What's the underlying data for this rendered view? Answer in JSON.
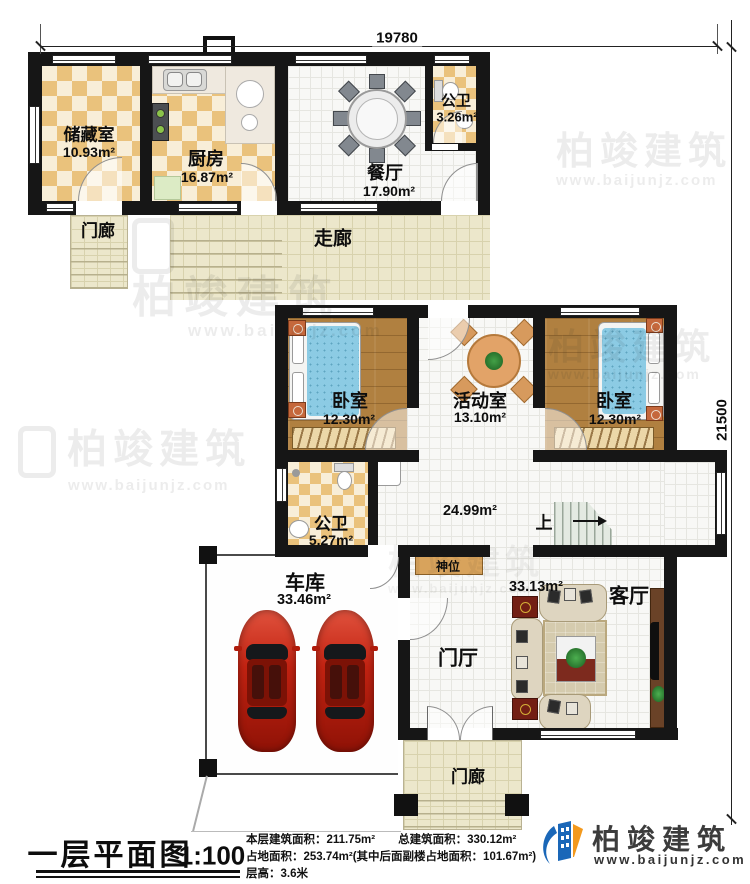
{
  "dimensions": {
    "top": "19780",
    "right": "21500"
  },
  "rooms": {
    "storage": {
      "name": "储藏室",
      "area": "10.93m²"
    },
    "kitchen": {
      "name": "厨房",
      "area": "16.87m²"
    },
    "dining": {
      "name": "餐厅",
      "area": "17.90m²"
    },
    "bath_top": {
      "name": "公卫",
      "area": "3.26m²"
    },
    "porch_top": {
      "name": "门廊"
    },
    "corridor": {
      "name": "走廊"
    },
    "bedroom_left": {
      "name": "卧室",
      "area": "12.30m²"
    },
    "activity": {
      "name": "活动室",
      "area": "13.10m²"
    },
    "bedroom_right": {
      "name": "卧室",
      "area": "12.30m²"
    },
    "bath_mid": {
      "name": "公卫",
      "area": "5.27m²"
    },
    "hall": {
      "area": "24.99m²"
    },
    "stairs": {
      "label": "上"
    },
    "shrine": {
      "name": "神位"
    },
    "garage": {
      "name": "车库",
      "area": "33.46m²"
    },
    "foyer": {
      "name": "门厅"
    },
    "living": {
      "name": "客厅",
      "area": "33.13m²"
    },
    "porch_bottom": {
      "name": "门廊"
    }
  },
  "title_block": {
    "title": "一层平面图",
    "scale": "1:100",
    "stats": [
      "本层建筑面积：211.75m²　　总建筑面积：330.12m²",
      "占地面积：253.74m²(其中后面副楼占地面积：101.67m²)",
      "层高：3.6米"
    ]
  },
  "brand": {
    "name": "柏竣建筑",
    "url": "www.baijunjz.com"
  },
  "watermark": {
    "name": "柏竣建筑",
    "url": "www.baijunjz.com"
  },
  "colors": {
    "wall": "#161616",
    "checker": "#eac27c",
    "wood": "#b08040",
    "logo_blue": "#1a67b8",
    "logo_orange": "#f3991d",
    "car_red": "#c21d0e"
  }
}
